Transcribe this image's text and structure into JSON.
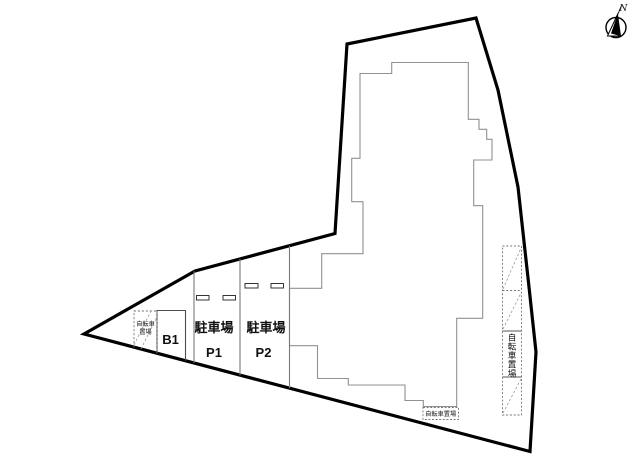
{
  "drawing": {
    "type": "site-plan",
    "background": "#ffffff",
    "boundary_color": "#000000",
    "building_color": "#919191",
    "divider_color": "#7a7a7a",
    "text_color": "#111111"
  },
  "compass": {
    "label": "N"
  },
  "areas": {
    "parking_p1": {
      "title": "駐車場",
      "code": "P1"
    },
    "parking_p2": {
      "title": "駐車場",
      "code": "P2"
    },
    "basement": {
      "code": "B1"
    },
    "bicycle_left": {
      "line1": "自転車",
      "line2": "置場"
    },
    "bicycle_bottom": {
      "label": "自転車置場"
    },
    "bicycle_right": {
      "chars": [
        "自",
        "転",
        "車",
        "置",
        "場"
      ]
    }
  }
}
